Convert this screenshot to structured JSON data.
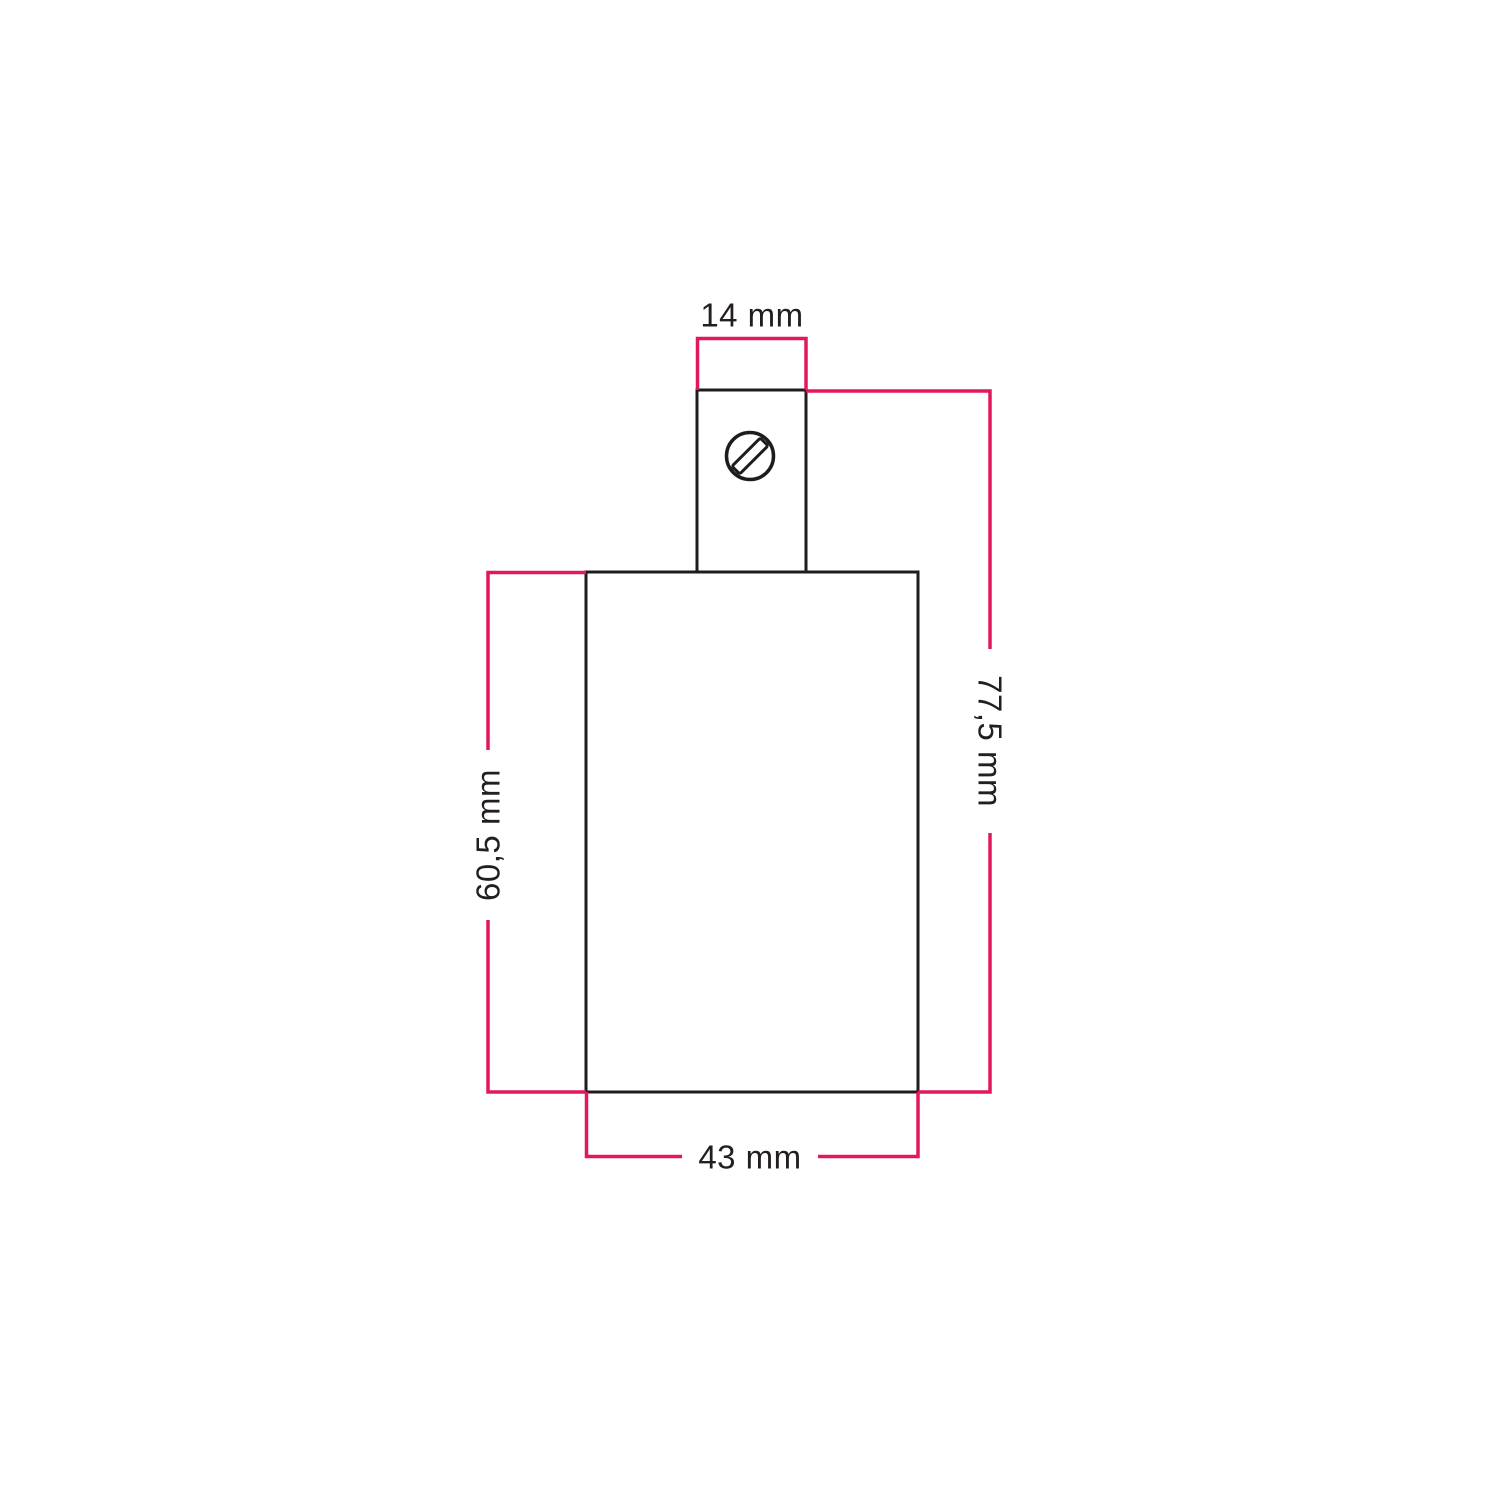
{
  "diagram": {
    "kind": "product-dimension-drawing",
    "part_views": {
      "cable_grip": "top narrow rectangle with screw",
      "body": "main rectangle"
    },
    "dimensions": {
      "grip_width": "14 mm",
      "total_height": "77,5 mm",
      "body_height": "60,5 mm",
      "body_width": "43 mm"
    },
    "icons": {
      "screw": "slotted-screw-head-icon"
    },
    "colors": {
      "dimension_line": "#e2185f",
      "outline": "#1d1d1b",
      "label_text": "#231f20",
      "background": "#ffffff"
    }
  }
}
